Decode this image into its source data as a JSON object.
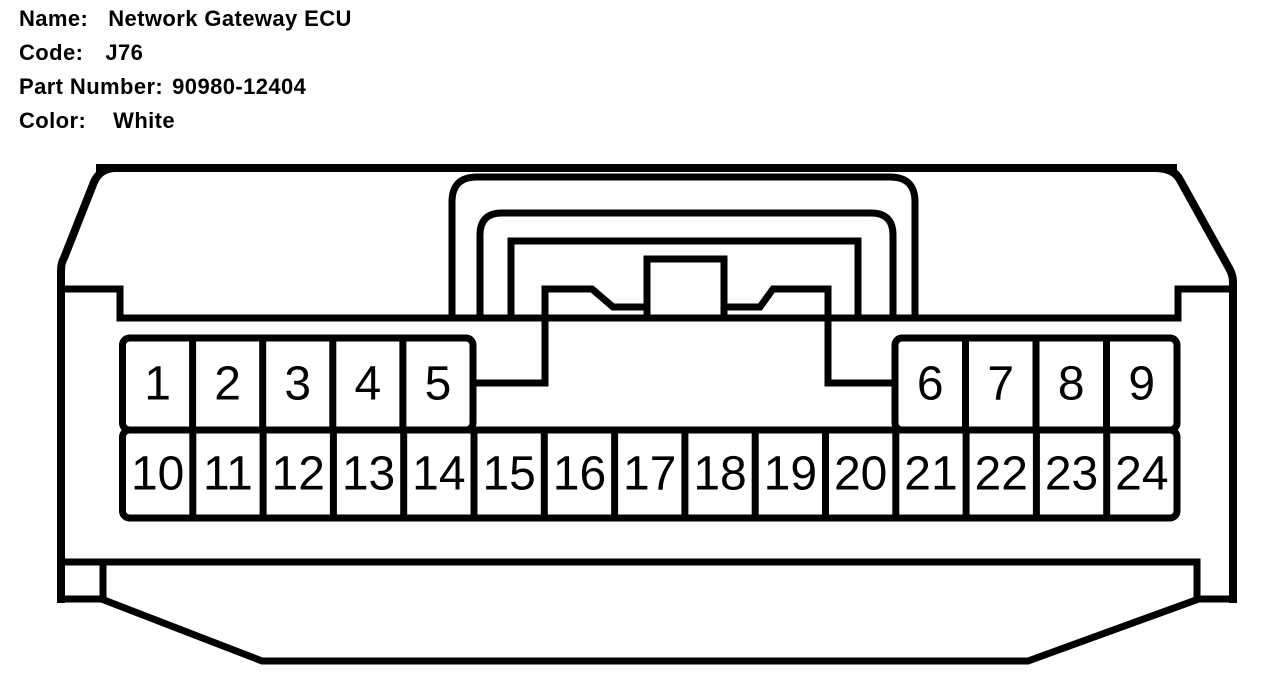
{
  "header": {
    "name_label": "Name:",
    "name_value": "Network Gateway ECU",
    "code_label": "Code:",
    "code_value": "J76",
    "part_label": "Part Number:",
    "part_value": "90980-12404",
    "color_label": "Color:",
    "color_value": "White"
  },
  "connector": {
    "kind": "pinout-diagram",
    "line_color": "#000000",
    "background_color": "#ffffff",
    "pin_groups": {
      "top_left": [
        "1",
        "2",
        "3",
        "4",
        "5"
      ],
      "top_right": [
        "6",
        "7",
        "8",
        "9"
      ],
      "bottom": [
        "10",
        "11",
        "12",
        "13",
        "14",
        "15",
        "16",
        "17",
        "18",
        "19",
        "20",
        "21",
        "22",
        "23",
        "24"
      ]
    }
  }
}
